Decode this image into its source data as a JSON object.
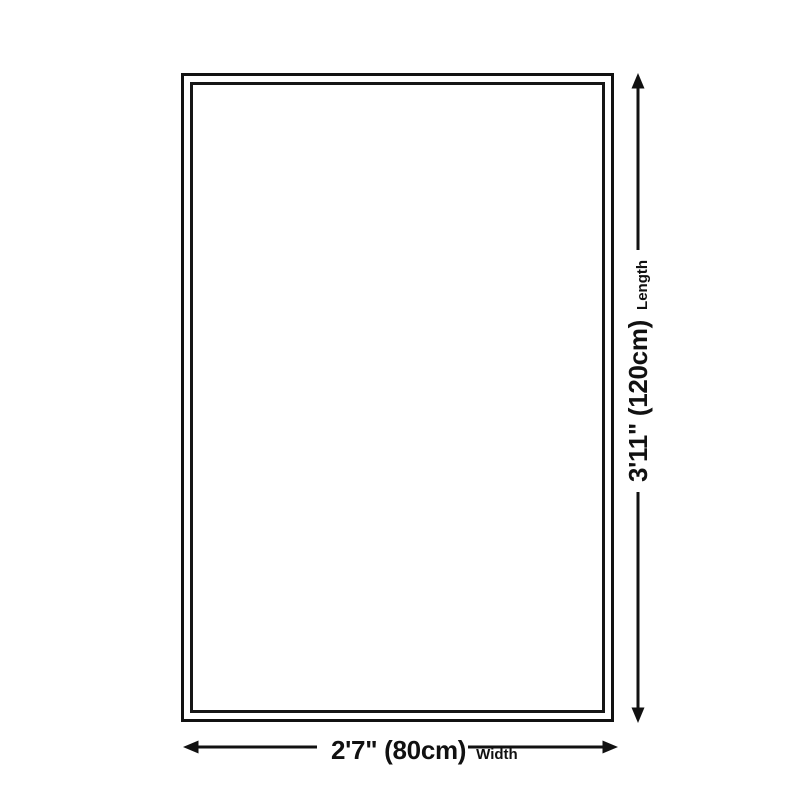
{
  "diagram": {
    "background_color": "#ffffff",
    "line_color": "#111111",
    "dimensions": {
      "length": {
        "value": "3'11\" (120cm)",
        "caption": "Length"
      },
      "width": {
        "value": "2'7\" (80cm)",
        "caption": "Width"
      }
    }
  }
}
